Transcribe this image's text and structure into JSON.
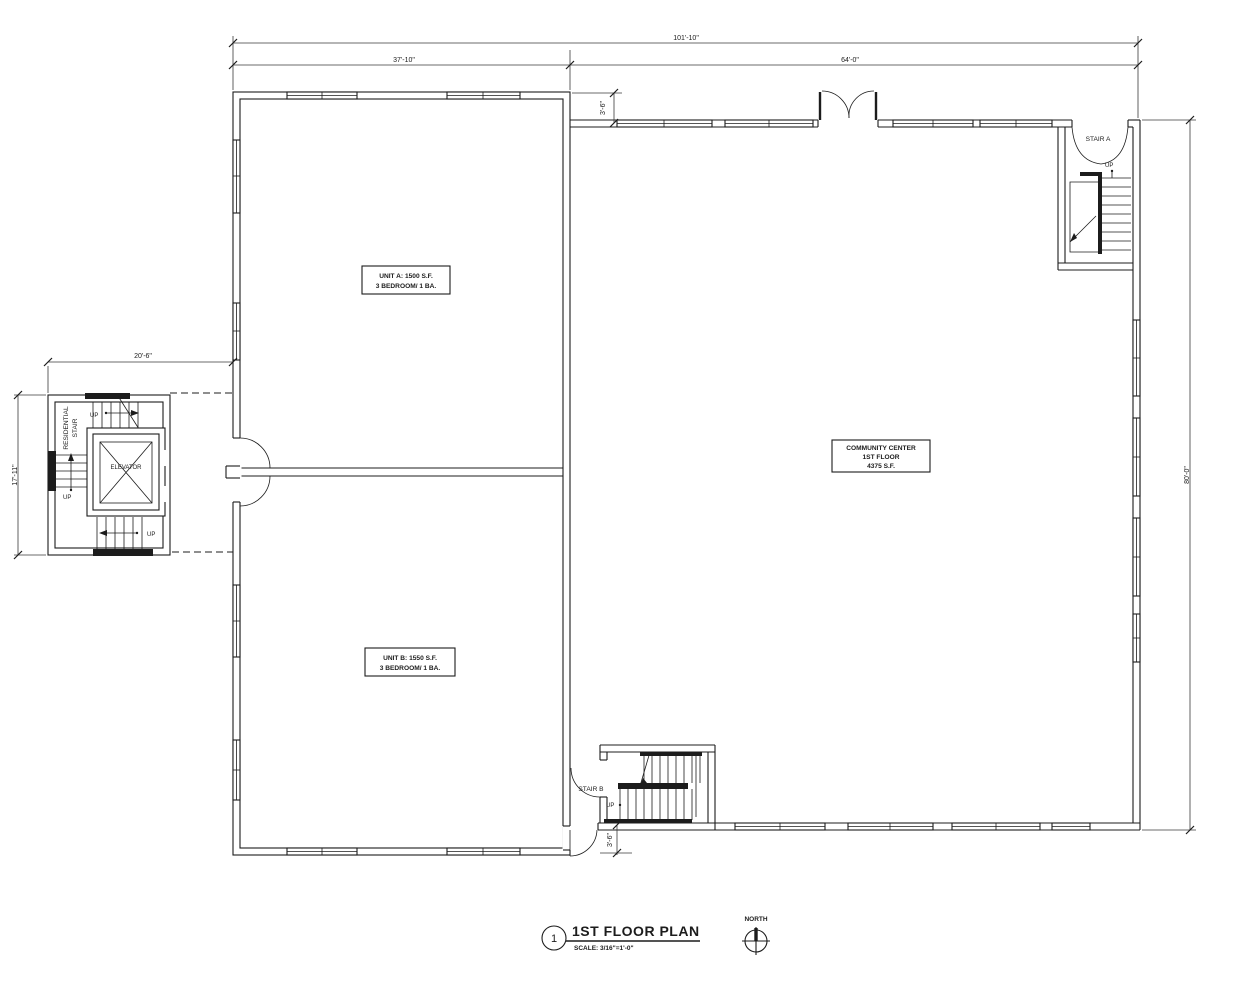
{
  "drawing": {
    "title_block": {
      "detail_number": "1",
      "title": "1ST FLOOR PLAN",
      "scale": "SCALE: 3/16\"=1'-0\"",
      "north_label": "NORTH"
    },
    "labels": {
      "unit_a_line1": "UNIT A: 1500 S.F.",
      "unit_a_line2": "3 BEDROOM/ 1 BA.",
      "unit_b_line1": "UNIT B: 1550 S.F.",
      "unit_b_line2": "3 BEDROOM/ 1 BA.",
      "community_line1": "COMMUNITY CENTER",
      "community_line2": "1ST FLOOR",
      "community_line3": "4375 S.F.",
      "stair_a": "STAIR A",
      "stair_b": "STAIR B",
      "elevator": "ELEVATOR",
      "residential_stair_line1": "RESIDENTIAL",
      "residential_stair_line2": "STAIR",
      "up": "UP"
    },
    "dimensions": {
      "overall_width": "101'-10\"",
      "left_wing_width": "37'-10\"",
      "community_width": "64'-0\"",
      "stair_tower_width": "20'-6\"",
      "stair_tower_height": "17'-11\"",
      "community_height": "80'-0\"",
      "top_wall_offset": "3'-6\"",
      "bottom_wall_offset": "3'-6\""
    },
    "colors": {
      "ink": "#1c1c1c",
      "background": "#ffffff"
    }
  }
}
